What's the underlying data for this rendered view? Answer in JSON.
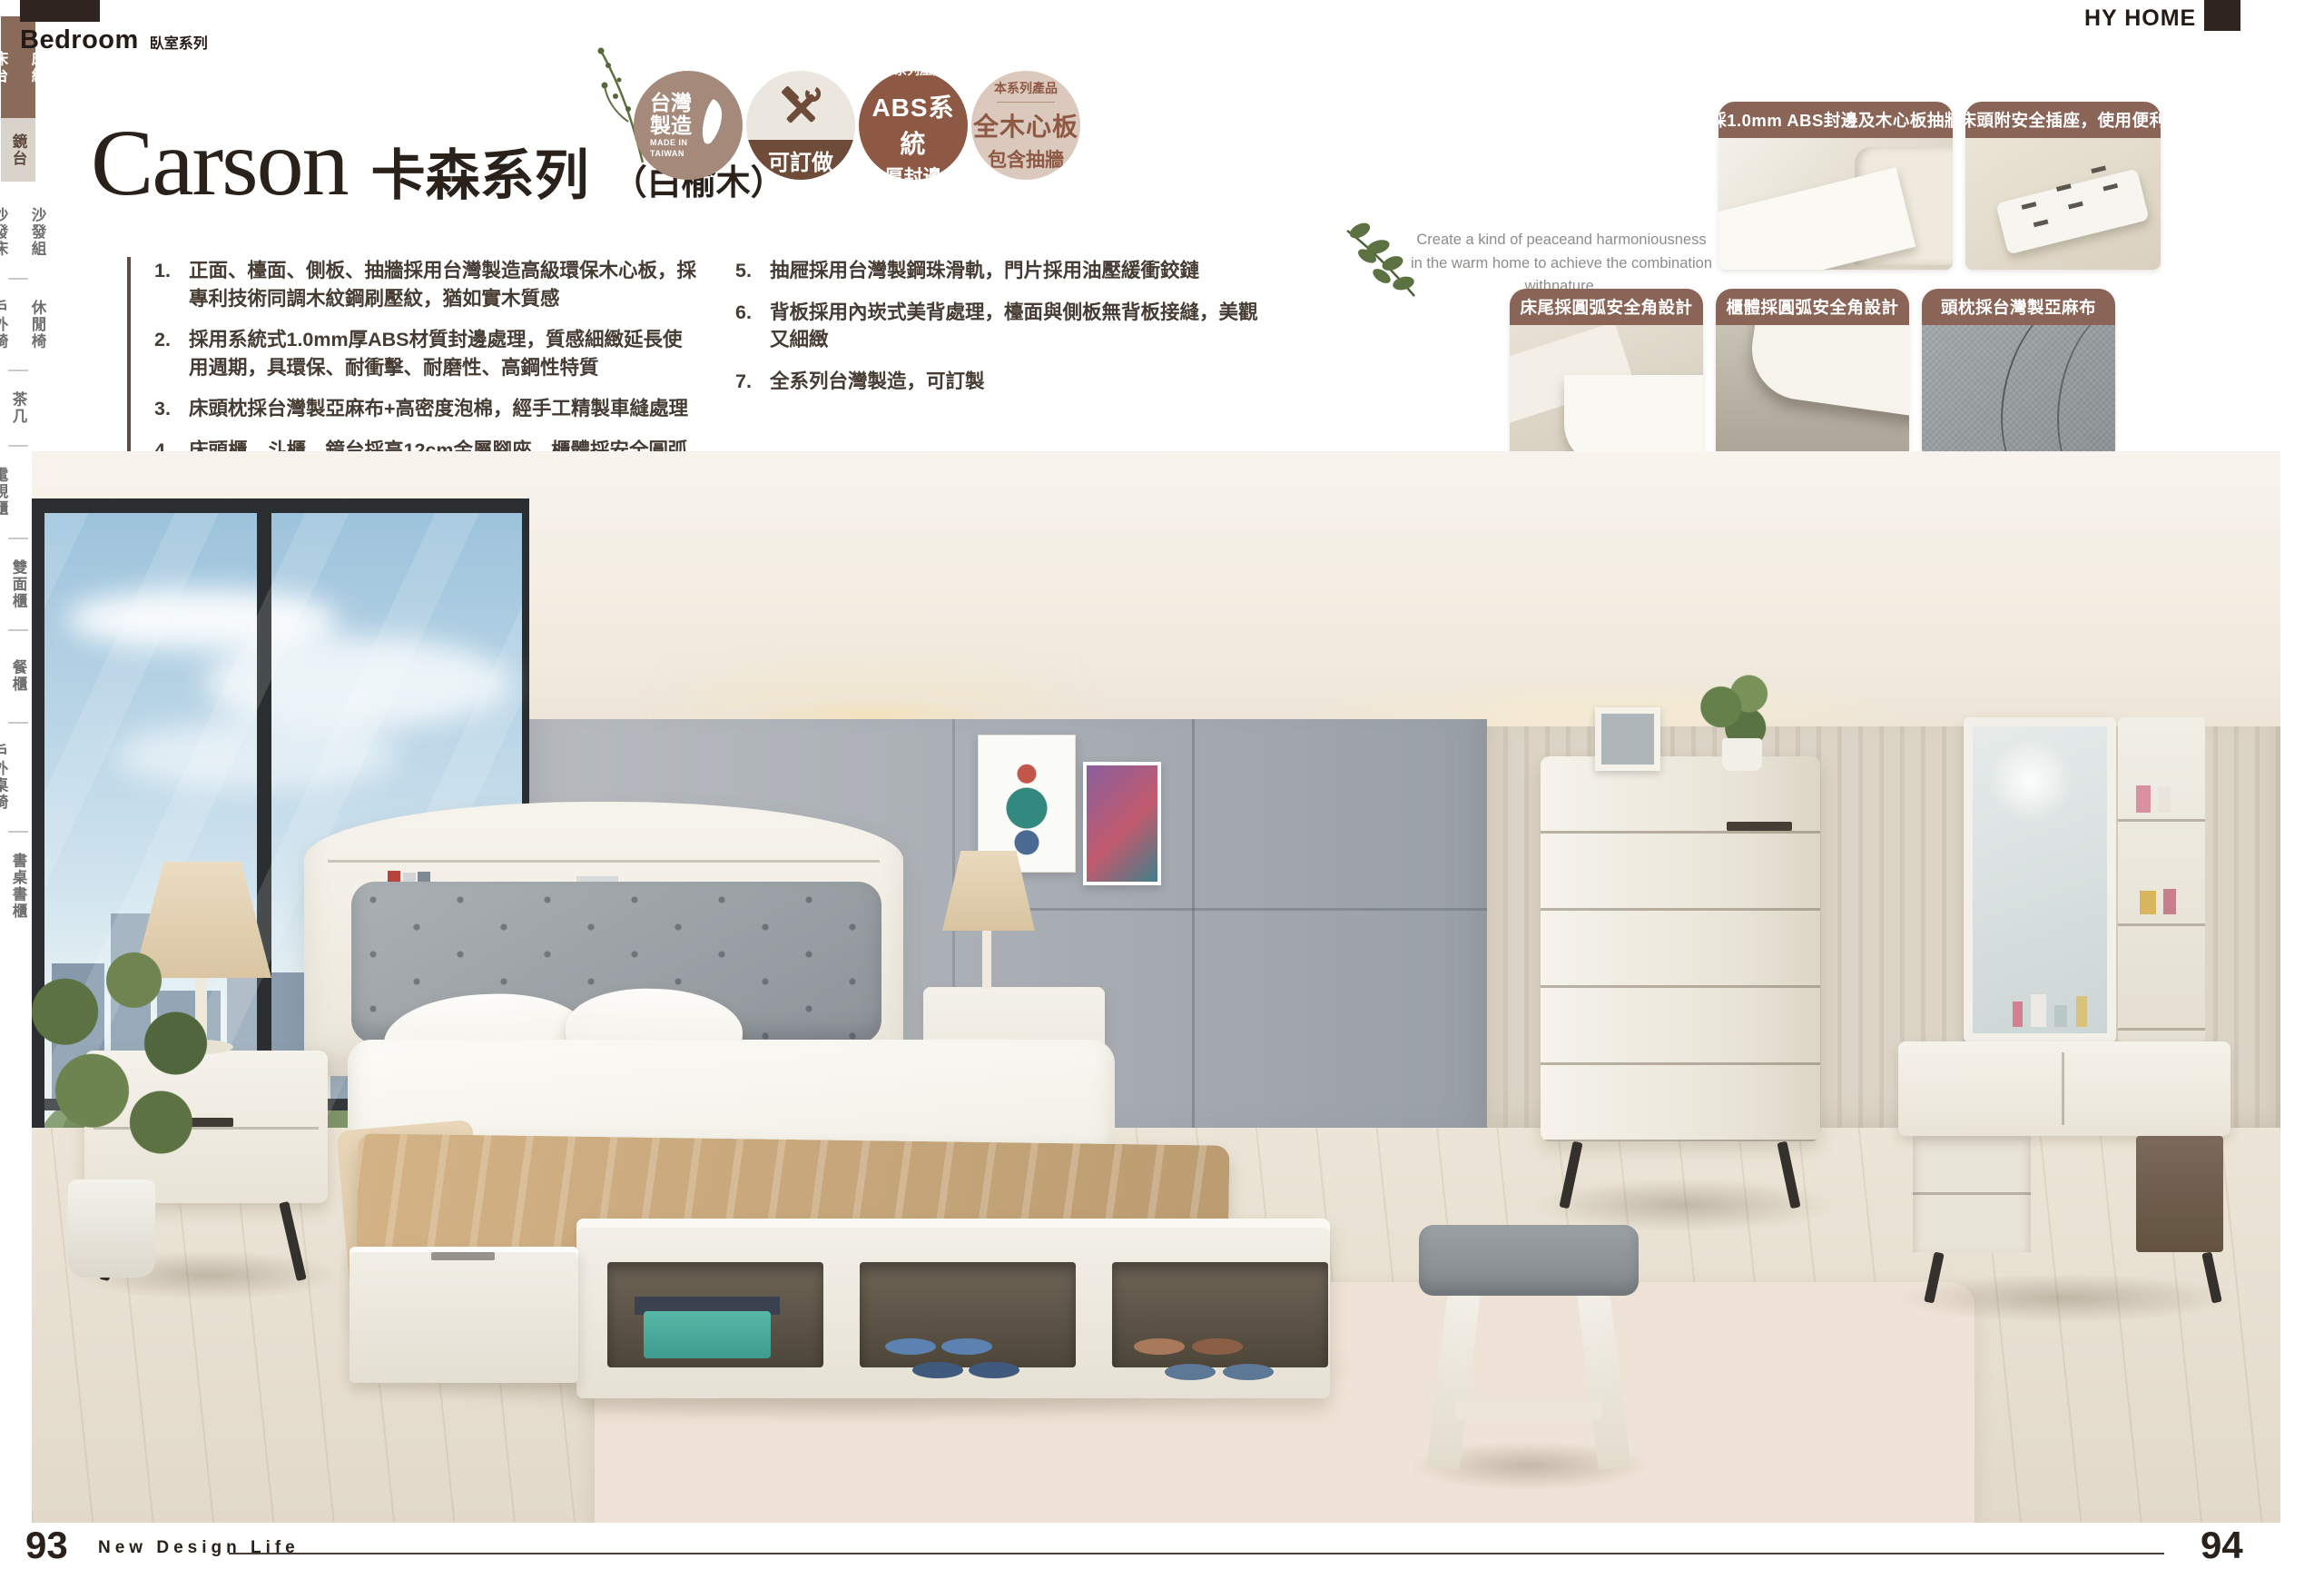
{
  "brand": {
    "name": "HY HOME",
    "accent_dark": "#2f2420",
    "accent_brown": "#8a6456",
    "sidebar_brown": "#8a6b5a"
  },
  "header": {
    "category_en": "Bedroom",
    "category_zh": "臥室系列"
  },
  "title": {
    "name_en": "Carson",
    "name_zh": "卡森系列",
    "material": "（白榆木）"
  },
  "badges": {
    "made_in_taiwan": {
      "zh1": "台灣",
      "zh2": "製造",
      "en1": "MADE IN",
      "en2": "TAIWAN"
    },
    "customizable": {
      "label": "可訂做"
    },
    "abs": {
      "top": "本系列產品",
      "main": "ABS系統",
      "sub": "厚封邊"
    },
    "wood_board": {
      "top": "本系列產品",
      "main": "全木心板",
      "sub": "包含抽牆"
    }
  },
  "features": {
    "left": [
      {
        "num": "1.",
        "text": "正面、檯面、側板、抽牆採用台灣製造高級環保木心板，採專利技術同調木紋鋼刷壓紋，猶如實木質感"
      },
      {
        "num": "2.",
        "text": "採用系統式1.0mm厚ABS材質封邊處理，質感細緻延長使用週期，具環保、耐衝擊、耐磨性、高鋼性特質"
      },
      {
        "num": "3.",
        "text": "床頭枕採台灣製亞麻布+高密度泡棉，經手工精製車縫處理"
      },
      {
        "num": "4.",
        "text": "床頭櫃、斗櫃、鏡台採高12cm金屬腳座，櫃體採安全圓弧角"
      }
    ],
    "right": [
      {
        "num": "5.",
        "text": "抽屜採用台灣製鋼珠滑軌，門片採用油壓緩衝鉸鏈"
      },
      {
        "num": "6.",
        "text": "背板採用內崁式美背處理，檯面與側板無背板接縫，美觀又細緻"
      },
      {
        "num": "7.",
        "text": "全系列台灣製造，可訂製"
      }
    ]
  },
  "quote": {
    "line1": "Create a kind of peaceand harmoniousness",
    "line2": "in the warm home to achieve the combination withnature."
  },
  "callouts": {
    "row1": [
      {
        "caption": "採1.0mm ABS封邊及木心板抽牆"
      },
      {
        "caption": "床頭附安全插座，使用便利"
      }
    ],
    "row2": [
      {
        "caption": "床尾採圓弧安全角設計"
      },
      {
        "caption": "櫃體採圓弧安全角設計"
      },
      {
        "caption": "頭枕採台灣製亞麻布"
      }
    ]
  },
  "sidebar": {
    "groups": [
      {
        "style": "active",
        "items": [
          "床組",
          "床台"
        ]
      },
      {
        "style": "highlight",
        "items": [
          "鏡台"
        ]
      },
      {
        "style": "normal",
        "items": [
          "沙發組",
          "沙發床"
        ]
      },
      {
        "style": "normal",
        "items": [
          "休閒椅",
          "戶外椅"
        ]
      },
      {
        "style": "normal",
        "items": [
          "茶几"
        ]
      },
      {
        "style": "normal",
        "items": [
          "展示櫃",
          "電視櫃"
        ]
      },
      {
        "style": "normal",
        "items": [
          "玄關桌",
          "雙面櫃",
          "鞋櫃"
        ]
      },
      {
        "style": "normal",
        "items": [
          "中島桌",
          "餐櫃",
          "收納櫃"
        ]
      },
      {
        "style": "normal",
        "items": [
          "餐桌椅",
          "戶外桌椅"
        ]
      },
      {
        "style": "normal",
        "items": [
          "書桌書櫃"
        ]
      }
    ]
  },
  "footer": {
    "page_left": "93",
    "tagline": "New Design Life",
    "page_right": "94"
  }
}
